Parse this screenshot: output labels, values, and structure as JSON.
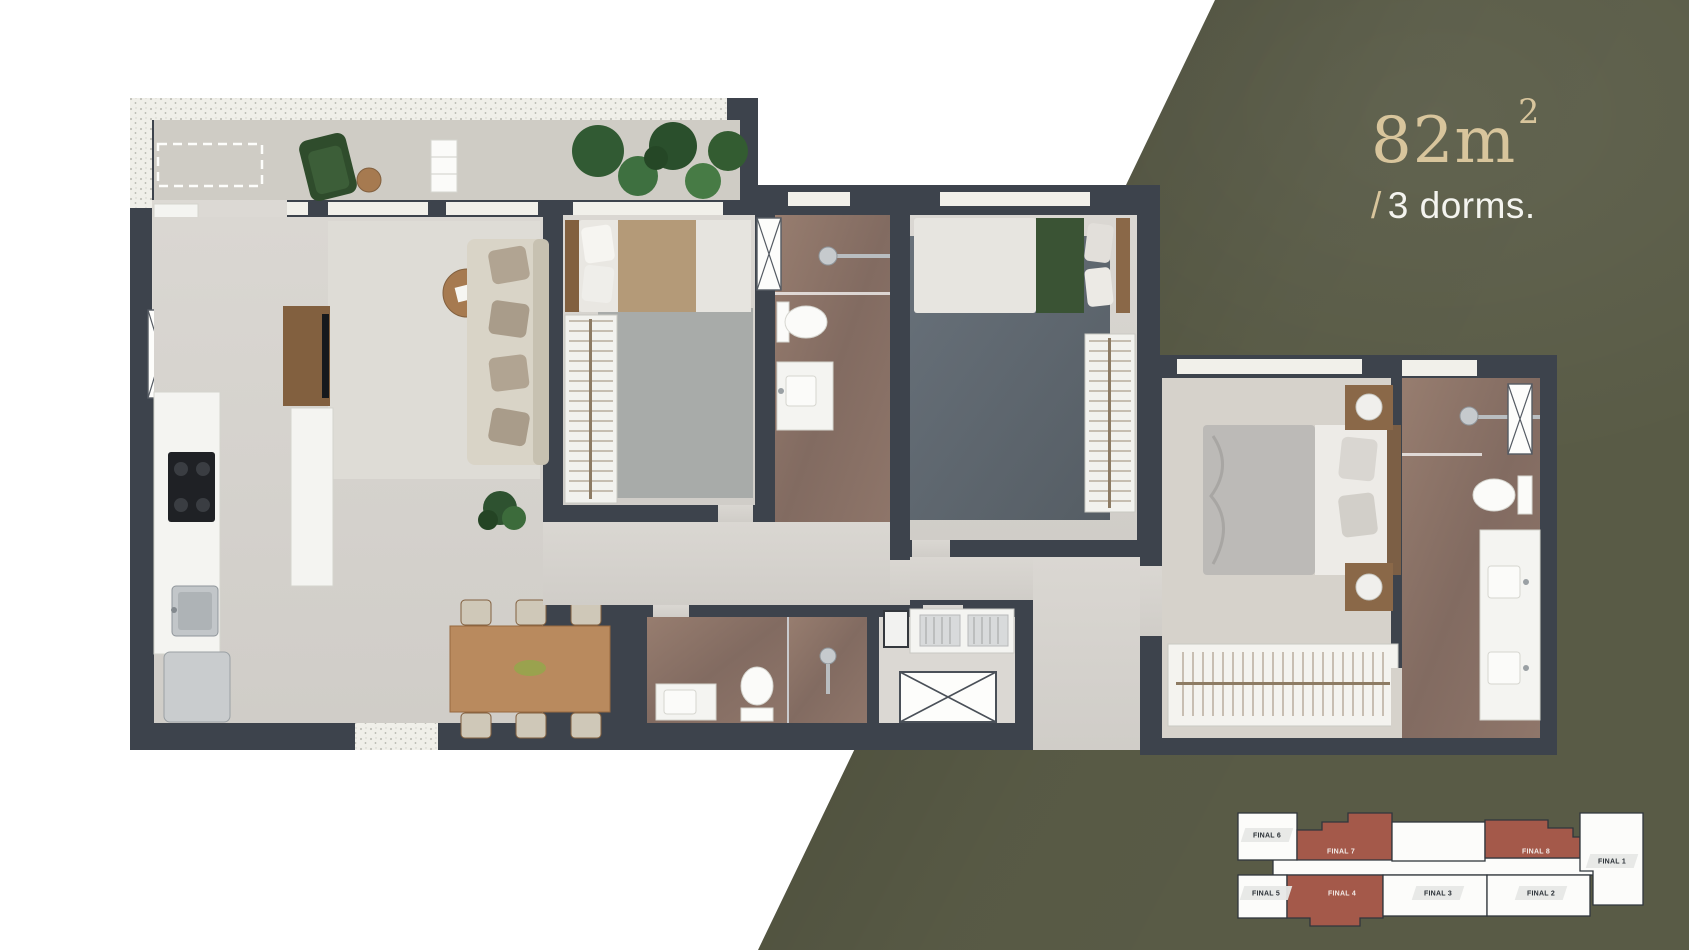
{
  "header": {
    "area_main": "82m",
    "area_sup": "2",
    "slash": "/",
    "dorms_text": "3 dorms."
  },
  "key_plan": {
    "units": [
      {
        "id": "final-6",
        "label": "FINAL 6",
        "highlighted": false
      },
      {
        "id": "final-7",
        "label": "FINAL 7",
        "highlighted": true
      },
      {
        "id": "final-8",
        "label": "FINAL 8",
        "highlighted": true
      },
      {
        "id": "final-1",
        "label": "FINAL 1",
        "highlighted": false
      },
      {
        "id": "final-5",
        "label": "FINAL 5",
        "highlighted": false
      },
      {
        "id": "final-4",
        "label": "FINAL 4",
        "highlighted": true
      },
      {
        "id": "final-3",
        "label": "FINAL 3",
        "highlighted": false
      },
      {
        "id": "final-2",
        "label": "FINAL 2",
        "highlighted": false
      }
    ]
  },
  "colors": {
    "olive": "#595b46",
    "brick": "#a4594a",
    "gold": "#d8c59c",
    "wall": "#3d434c"
  }
}
